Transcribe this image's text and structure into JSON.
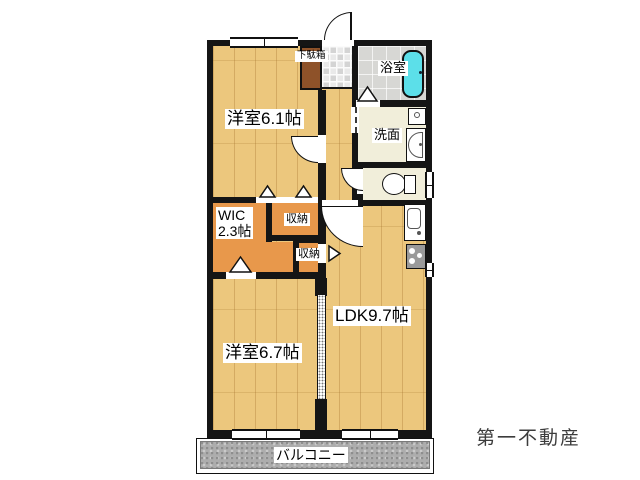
{
  "rooms": {
    "bedroom1": {
      "label": "洋室6.1帖"
    },
    "bedroom2": {
      "label": "洋室6.7帖"
    },
    "ldk": {
      "label": "LDK9.7帖"
    },
    "wic": {
      "line1": "WIC",
      "line2": "2.3帖"
    },
    "storage1": {
      "label": "収納"
    },
    "storage2": {
      "label": "収納"
    },
    "bath": {
      "label": "浴室"
    },
    "washroom": {
      "label": "洗面"
    },
    "shoe_cabinet": {
      "label": "下駄箱"
    },
    "balcony": {
      "label": "バルコニー"
    }
  },
  "footer": {
    "company": "第一不動産"
  },
  "colors": {
    "wall": "#151515",
    "wood_floor": "#ecc77d",
    "closet_orange": "#e8984b",
    "shoe_cabinet_brown": "#8e5229",
    "bathtub_cyan": "#5cdfe9",
    "balcony_gray": "#adadad",
    "company_text": "#3c3c3c"
  }
}
